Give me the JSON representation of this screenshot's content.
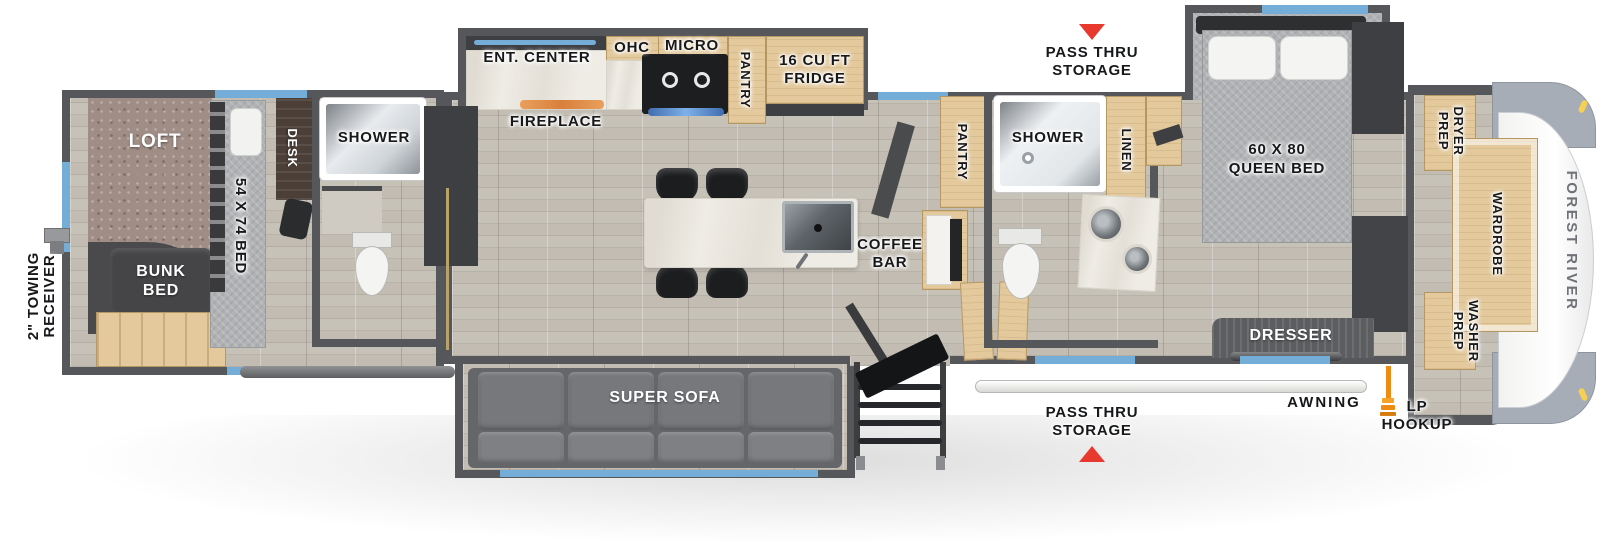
{
  "colors": {
    "wall": "#55575b",
    "floor_wood": "#c7c2b8",
    "window_blue": "#74add8",
    "arrow_red": "#e8392f",
    "lp_orange": "#ee8b12",
    "cabinet_tan": "#e3c99c",
    "marble": "#efece5",
    "carpet_brown": "#a08d86",
    "bed_gray": "#b0b2b5",
    "sofa_gray": "#6e7073",
    "cap_gray": "#a6adb6"
  },
  "exterior": {
    "towing_receiver": "2\" TOWING\nRECEIVER",
    "pass_thru_storage_top": "PASS THRU\nSTORAGE",
    "pass_thru_storage_bottom": "PASS THRU\nSTORAGE",
    "awning": "AWNING",
    "lp_hookup": "LP\nHOOKUP",
    "brand": "FOREST RIVER"
  },
  "bunk_room": {
    "loft": "LOFT",
    "bed": "54 X 74 BED",
    "bunk_bed": "BUNK\nBED",
    "desk": "DESK",
    "shower": "SHOWER"
  },
  "kitchen": {
    "ent_center": "ENT. CENTER",
    "fireplace": "FIREPLACE",
    "ohc": "OHC",
    "micro": "MICRO",
    "pantry": "PANTRY",
    "fridge": "16 CU FT\nFRIDGE",
    "coffee_bar": "COFFEE\nBAR"
  },
  "living_room": {
    "super_sofa": "SUPER SOFA"
  },
  "mid_bath": {
    "pantry": "PANTRY",
    "shower": "SHOWER",
    "linen": "LINEN"
  },
  "bedroom": {
    "queen_bed": "60 X 80\nQUEEN BED",
    "dresser": "DRESSER"
  },
  "front_closet": {
    "dryer_prep": "DRYER\nPREP",
    "wardrobe": "WARDROBE",
    "washer_prep": "WASHER\nPREP"
  }
}
